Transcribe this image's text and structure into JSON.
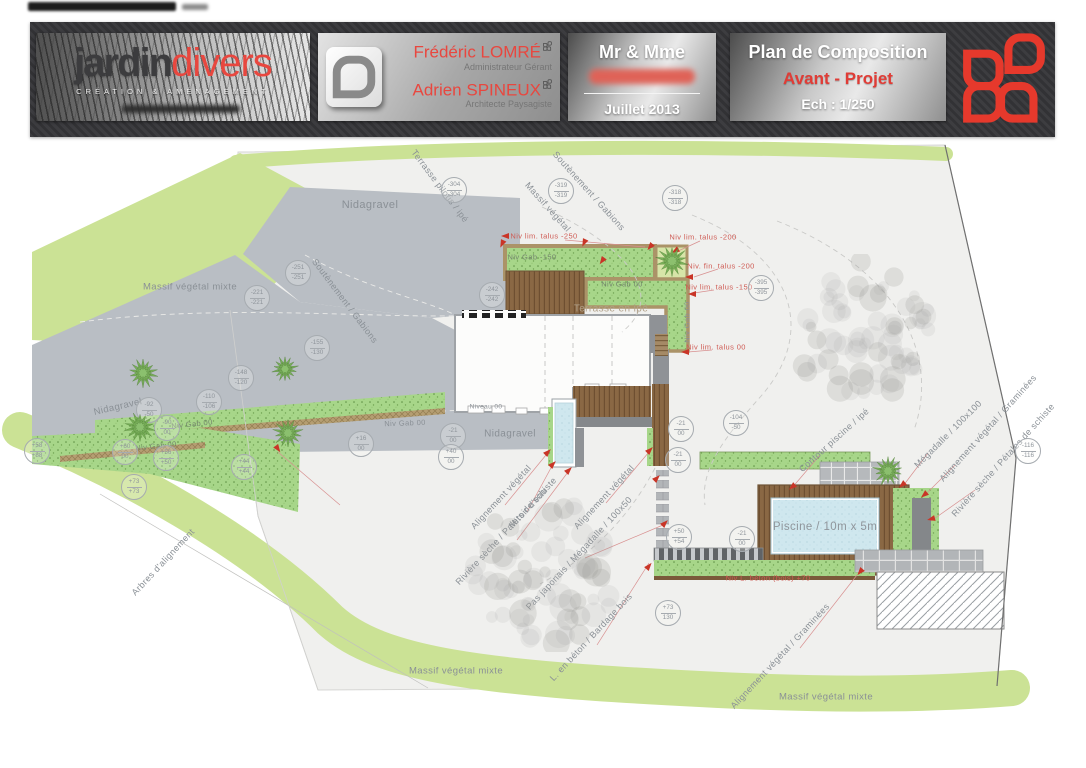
{
  "header": {
    "logo": {
      "word1": "jardin",
      "word2": "divers",
      "tagline": "CRÉATION & AMÉNAGEMENT"
    },
    "team": {
      "person1_name": "Frédéric LOMRÉ",
      "person1_role": "Administrateur Gérant",
      "person2_name": "Adrien SPINEUX",
      "person2_role": "Architecte Paysagiste"
    },
    "client": {
      "title": "Mr & Mme",
      "date": "Juillet 2013"
    },
    "title_block": {
      "title": "Plan de Composition",
      "subtitle": "Avant - Projet",
      "scale": "Ech : 1/250"
    },
    "colors": {
      "accent_red": "#e8473f",
      "band_dark": "#39393b"
    }
  },
  "plan": {
    "labels": [
      {
        "t": "Nidagravel",
        "x": 370,
        "y": 205,
        "r": 0,
        "s": 11
      },
      {
        "t": "Terrasse pilotis / ipé",
        "x": 440,
        "y": 186,
        "r": 53,
        "s": 9
      },
      {
        "t": "Soutènement / Gabions",
        "x": 345,
        "y": 301,
        "r": 53,
        "s": 9
      },
      {
        "t": "Soutènement / Gabions",
        "x": 589,
        "y": 191,
        "r": 48,
        "s": 9
      },
      {
        "t": "Massif végétal",
        "x": 548,
        "y": 207,
        "r": 48,
        "s": 9
      },
      {
        "t": "Massif végétal mixte",
        "x": 190,
        "y": 287,
        "r": 0,
        "s": 9.5
      },
      {
        "t": "Nidagravel",
        "x": 118,
        "y": 407,
        "r": -13,
        "s": 9.5
      },
      {
        "t": "Nidagravel",
        "x": 510,
        "y": 434,
        "r": 0,
        "s": 10
      },
      {
        "t": "Niveau 00",
        "x": 486,
        "y": 407,
        "r": 0,
        "s": 6.5
      },
      {
        "t": "Terrasse en ipé",
        "x": 611,
        "y": 309,
        "r": 0,
        "s": 10,
        "c": "#b0a089"
      },
      {
        "t": "Niv Gab -150",
        "x": 532,
        "y": 257,
        "r": 0,
        "s": 7.5,
        "c": "#74856d"
      },
      {
        "t": "Niv Gab 00",
        "x": 622,
        "y": 284,
        "r": 0,
        "s": 7.5,
        "c": "#74856d"
      },
      {
        "t": "Niv Gab 00",
        "x": 687,
        "y": 322,
        "r": -90,
        "s": 7.5,
        "c": "#8a9096"
      },
      {
        "t": "Niv Gab 00",
        "x": 405,
        "y": 423,
        "r": -2,
        "s": 7.5,
        "c": "#8a9096"
      },
      {
        "t": "Niv Gab 00",
        "x": 192,
        "y": 424,
        "r": -6,
        "s": 7.5,
        "c": "#74856d"
      },
      {
        "t": "Niv Gab 00",
        "x": 156,
        "y": 446,
        "r": -6,
        "s": 7.5,
        "c": "#74856d"
      },
      {
        "t": "Niv lim. talus -250",
        "x": 544,
        "y": 236,
        "r": 0,
        "s": 7.5,
        "c": "#cf5c55"
      },
      {
        "t": "Niv lim. talus -200",
        "x": 703,
        "y": 237,
        "r": 0,
        "s": 7.5,
        "c": "#cf5c55"
      },
      {
        "t": "Niv. fin. talus -200",
        "x": 721,
        "y": 266,
        "r": 0,
        "s": 7.5,
        "c": "#cf5c55"
      },
      {
        "t": "Niv lim. talus -150",
        "x": 719,
        "y": 287,
        "r": 0,
        "s": 7.5,
        "c": "#cf5c55"
      },
      {
        "t": "Niv lim. talus 00",
        "x": 716,
        "y": 347,
        "r": 0,
        "s": 7.5,
        "c": "#cf5c55"
      },
      {
        "t": "Niv L. béton (bois) +70",
        "x": 768,
        "y": 578,
        "r": 0,
        "s": 7.5,
        "c": "#cf5c55"
      },
      {
        "t": "Alignement végétal",
        "x": 501,
        "y": 497,
        "r": -47,
        "s": 9
      },
      {
        "t": "Miroir d'eau",
        "x": 528,
        "y": 508,
        "r": -47,
        "s": 9
      },
      {
        "t": "Rivière sèche / Palets de schiste",
        "x": 506,
        "y": 531,
        "r": -47,
        "s": 9
      },
      {
        "t": "Alignement végétal",
        "x": 604,
        "y": 497,
        "r": -47,
        "s": 9
      },
      {
        "t": "Pas japonais / Mégadalle / 100x50",
        "x": 579,
        "y": 553,
        "r": -47,
        "s": 9
      },
      {
        "t": "L. en béton / Bardage bois",
        "x": 591,
        "y": 637,
        "r": -47,
        "s": 9
      },
      {
        "t": "Arbres d'alignement",
        "x": 163,
        "y": 562,
        "r": -47,
        "s": 9
      },
      {
        "t": "Contour piscine / ipé",
        "x": 834,
        "y": 440,
        "r": -42,
        "s": 9
      },
      {
        "t": "Mégadalle / 100x100",
        "x": 948,
        "y": 434,
        "r": -45,
        "s": 9
      },
      {
        "t": "Alignement végétal / Graminées",
        "x": 988,
        "y": 428,
        "r": -48,
        "s": 9
      },
      {
        "t": "Rivière sèche / Pétales de schiste",
        "x": 1003,
        "y": 460,
        "r": -48,
        "s": 9
      },
      {
        "t": "Alignement végétal / Graminées",
        "x": 780,
        "y": 656,
        "r": -47,
        "s": 9
      },
      {
        "t": "Massif végétal mixte",
        "x": 456,
        "y": 671,
        "r": 0,
        "s": 9.5
      },
      {
        "t": "Massif végétal mixte",
        "x": 826,
        "y": 697,
        "r": 0,
        "s": 9.5
      },
      {
        "t": "Piscine / 10m x 5m",
        "x": 825,
        "y": 527,
        "r": 0,
        "s": 11.5,
        "c": "#8f959b"
      }
    ],
    "level_markers": [
      {
        "x": 453,
        "y": 189,
        "a": "-304",
        "b": "-304"
      },
      {
        "x": 560,
        "y": 190,
        "a": "-319",
        "b": "-319"
      },
      {
        "x": 674,
        "y": 197,
        "a": "-318",
        "b": "-318"
      },
      {
        "x": 760,
        "y": 287,
        "a": "-395",
        "b": "-395"
      },
      {
        "x": 297,
        "y": 272,
        "a": "-251",
        "b": "-251"
      },
      {
        "x": 256,
        "y": 297,
        "a": "-221",
        "b": "-221"
      },
      {
        "x": 316,
        "y": 347,
        "a": "-155",
        "b": "-130"
      },
      {
        "x": 240,
        "y": 377,
        "a": "-148",
        "b": "-120"
      },
      {
        "x": 208,
        "y": 401,
        "a": "-110",
        "b": "-106"
      },
      {
        "x": 148,
        "y": 409,
        "a": "-92",
        "b": "-50"
      },
      {
        "x": 166,
        "y": 427,
        "a": "-90",
        "b": "00"
      },
      {
        "x": 124,
        "y": 451,
        "a": "+60",
        "b": "00"
      },
      {
        "x": 165,
        "y": 457,
        "a": "+56",
        "b": "+50"
      },
      {
        "x": 243,
        "y": 466,
        "a": "+44",
        "b": "+44"
      },
      {
        "x": 36,
        "y": 450,
        "a": "+58",
        "b": "+88"
      },
      {
        "x": 133,
        "y": 486,
        "a": "+73",
        "b": "+73"
      },
      {
        "x": 491,
        "y": 294,
        "a": "-242",
        "b": "-242"
      },
      {
        "x": 360,
        "y": 443,
        "a": "+16",
        "b": "00"
      },
      {
        "x": 452,
        "y": 435,
        "a": "-21",
        "b": "00"
      },
      {
        "x": 450,
        "y": 456,
        "a": "+40",
        "b": "00"
      },
      {
        "x": 680,
        "y": 428,
        "a": "-21",
        "b": "00"
      },
      {
        "x": 677,
        "y": 459,
        "a": "-21",
        "b": "00"
      },
      {
        "x": 735,
        "y": 422,
        "a": "-104",
        "b": "-50"
      },
      {
        "x": 678,
        "y": 536,
        "a": "+50",
        "b": "+54"
      },
      {
        "x": 741,
        "y": 538,
        "a": "-21",
        "b": "00"
      },
      {
        "x": 667,
        "y": 612,
        "a": "+73",
        "b": "130"
      },
      {
        "x": 1027,
        "y": 450,
        "a": "-116",
        "b": "-116"
      }
    ],
    "arrows": [
      {
        "x": 503,
        "y": 236,
        "r": 180
      },
      {
        "x": 500,
        "y": 244,
        "r": 115
      },
      {
        "x": 582,
        "y": 243,
        "r": 115
      },
      {
        "x": 648,
        "y": 247,
        "r": 130
      },
      {
        "x": 673,
        "y": 251,
        "r": 150
      },
      {
        "x": 600,
        "y": 261,
        "r": 125
      },
      {
        "x": 687,
        "y": 277,
        "r": 180
      },
      {
        "x": 690,
        "y": 294,
        "r": 180
      },
      {
        "x": 683,
        "y": 352,
        "r": 180
      },
      {
        "x": 276,
        "y": 449,
        "r": 55
      },
      {
        "x": 546,
        "y": 452,
        "r": -45
      },
      {
        "x": 551,
        "y": 464,
        "r": -45
      },
      {
        "x": 567,
        "y": 470,
        "r": -45
      },
      {
        "x": 648,
        "y": 450,
        "r": -45
      },
      {
        "x": 655,
        "y": 478,
        "r": -45
      },
      {
        "x": 663,
        "y": 523,
        "r": -45
      },
      {
        "x": 647,
        "y": 566,
        "r": -50
      },
      {
        "x": 858,
        "y": 572,
        "r": 130
      },
      {
        "x": 790,
        "y": 487,
        "r": 140
      },
      {
        "x": 900,
        "y": 485,
        "r": 140
      },
      {
        "x": 922,
        "y": 495,
        "r": 140
      },
      {
        "x": 929,
        "y": 519,
        "r": 165
      }
    ],
    "trees_green": [
      {
        "x": 143,
        "y": 373,
        "r": 15
      },
      {
        "x": 285,
        "y": 369,
        "r": 13
      },
      {
        "x": 140,
        "y": 427,
        "r": 15
      },
      {
        "x": 288,
        "y": 433,
        "r": 15
      },
      {
        "x": 672,
        "y": 261,
        "r": 16
      },
      {
        "x": 888,
        "y": 471,
        "r": 15
      }
    ],
    "trees_gray": [
      {
        "x": 545,
        "y": 572,
        "r": 80
      },
      {
        "x": 862,
        "y": 330,
        "r": 76
      }
    ]
  }
}
